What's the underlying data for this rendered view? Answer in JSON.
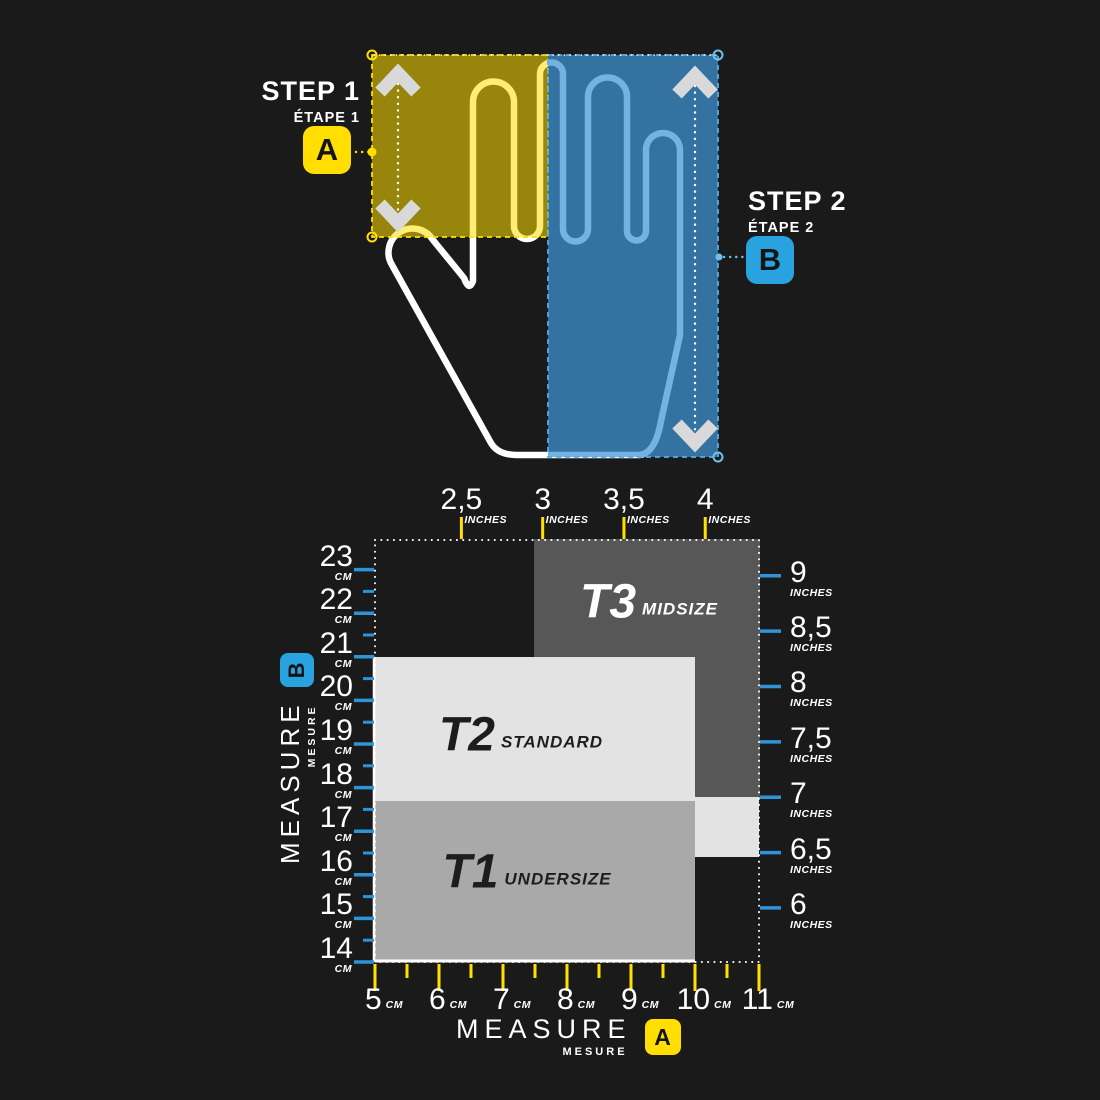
{
  "background": "#1a1a1a",
  "palette": {
    "yellow": "#ffde00",
    "blue_badge": "#29a3e0",
    "blue_overlay": "#3e96d6",
    "blue_overlay_stroke": "#55ade4",
    "tick_yellow": "#ffe000",
    "tick_blue": "#2f93d8",
    "arrow_gray": "#d9d9d9",
    "hand_stroke": "#ffffff",
    "boundary_white": "#ffffff"
  },
  "step1": {
    "title": "STEP 1",
    "subtitle": "ÉTAPE 1",
    "badge": "A"
  },
  "step2": {
    "title": "STEP 2",
    "subtitle": "ÉTAPE 2",
    "badge": "B"
  },
  "measure_bottom": {
    "title": "MEASURE",
    "subtitle": "MESURE",
    "badge": "A"
  },
  "measure_left": {
    "title": "MEASURE",
    "subtitle": "MESURE",
    "badge": "B"
  },
  "chart_data": {
    "type": "size-region-chart",
    "x_axis_bottom": {
      "label": "MEASURE A (hand width)",
      "unit": "CM",
      "ticks": [
        5,
        6,
        7,
        8,
        9,
        10,
        11
      ],
      "tick_labels": [
        "5",
        "6",
        "7",
        "8",
        "9",
        "10",
        "11"
      ]
    },
    "x_axis_top": {
      "unit": "INCHES",
      "ticks": [
        2.5,
        3,
        3.5,
        4
      ],
      "tick_labels": [
        "2,5",
        "3",
        "3,5",
        "4"
      ]
    },
    "y_axis_left": {
      "label": "MEASURE B (hand length)",
      "unit": "CM",
      "ticks": [
        23,
        22,
        21,
        20,
        19,
        18,
        17,
        16,
        15,
        14
      ],
      "tick_labels": [
        "23",
        "22",
        "21",
        "20",
        "19",
        "18",
        "17",
        "16",
        "15",
        "14"
      ]
    },
    "y_axis_right": {
      "unit": "INCHES",
      "ticks": [
        9,
        8.5,
        8,
        7.5,
        7,
        6.5,
        6
      ],
      "tick_labels": [
        "9",
        "8,5",
        "8",
        "7,5",
        "7",
        "6,5",
        "6"
      ]
    },
    "sizes": [
      {
        "id": "T3",
        "name": "MIDSIZE",
        "color": "#575757",
        "text_color": "#ffffff",
        "regions_cm": [
          {
            "width": [
              7.5,
              11
            ],
            "length": [
              17.78,
              23.67
            ]
          }
        ]
      },
      {
        "id": "T2",
        "name": "STANDARD",
        "color": "#e3e3e3",
        "text_color": "#1d1d1d",
        "regions_cm": [
          {
            "width": [
              5,
              10
            ],
            "length": [
              17.7,
              21
            ]
          },
          {
            "width": [
              10,
              11
            ],
            "length": [
              16.4,
              17.78
            ]
          }
        ]
      },
      {
        "id": "T1",
        "name": "UNDERSIZE",
        "color": "#a9a9a9",
        "text_color": "#1d1d1d",
        "regions_cm": [
          {
            "width": [
              5,
              10
            ],
            "length": [
              14,
              17.7
            ]
          }
        ]
      }
    ]
  }
}
